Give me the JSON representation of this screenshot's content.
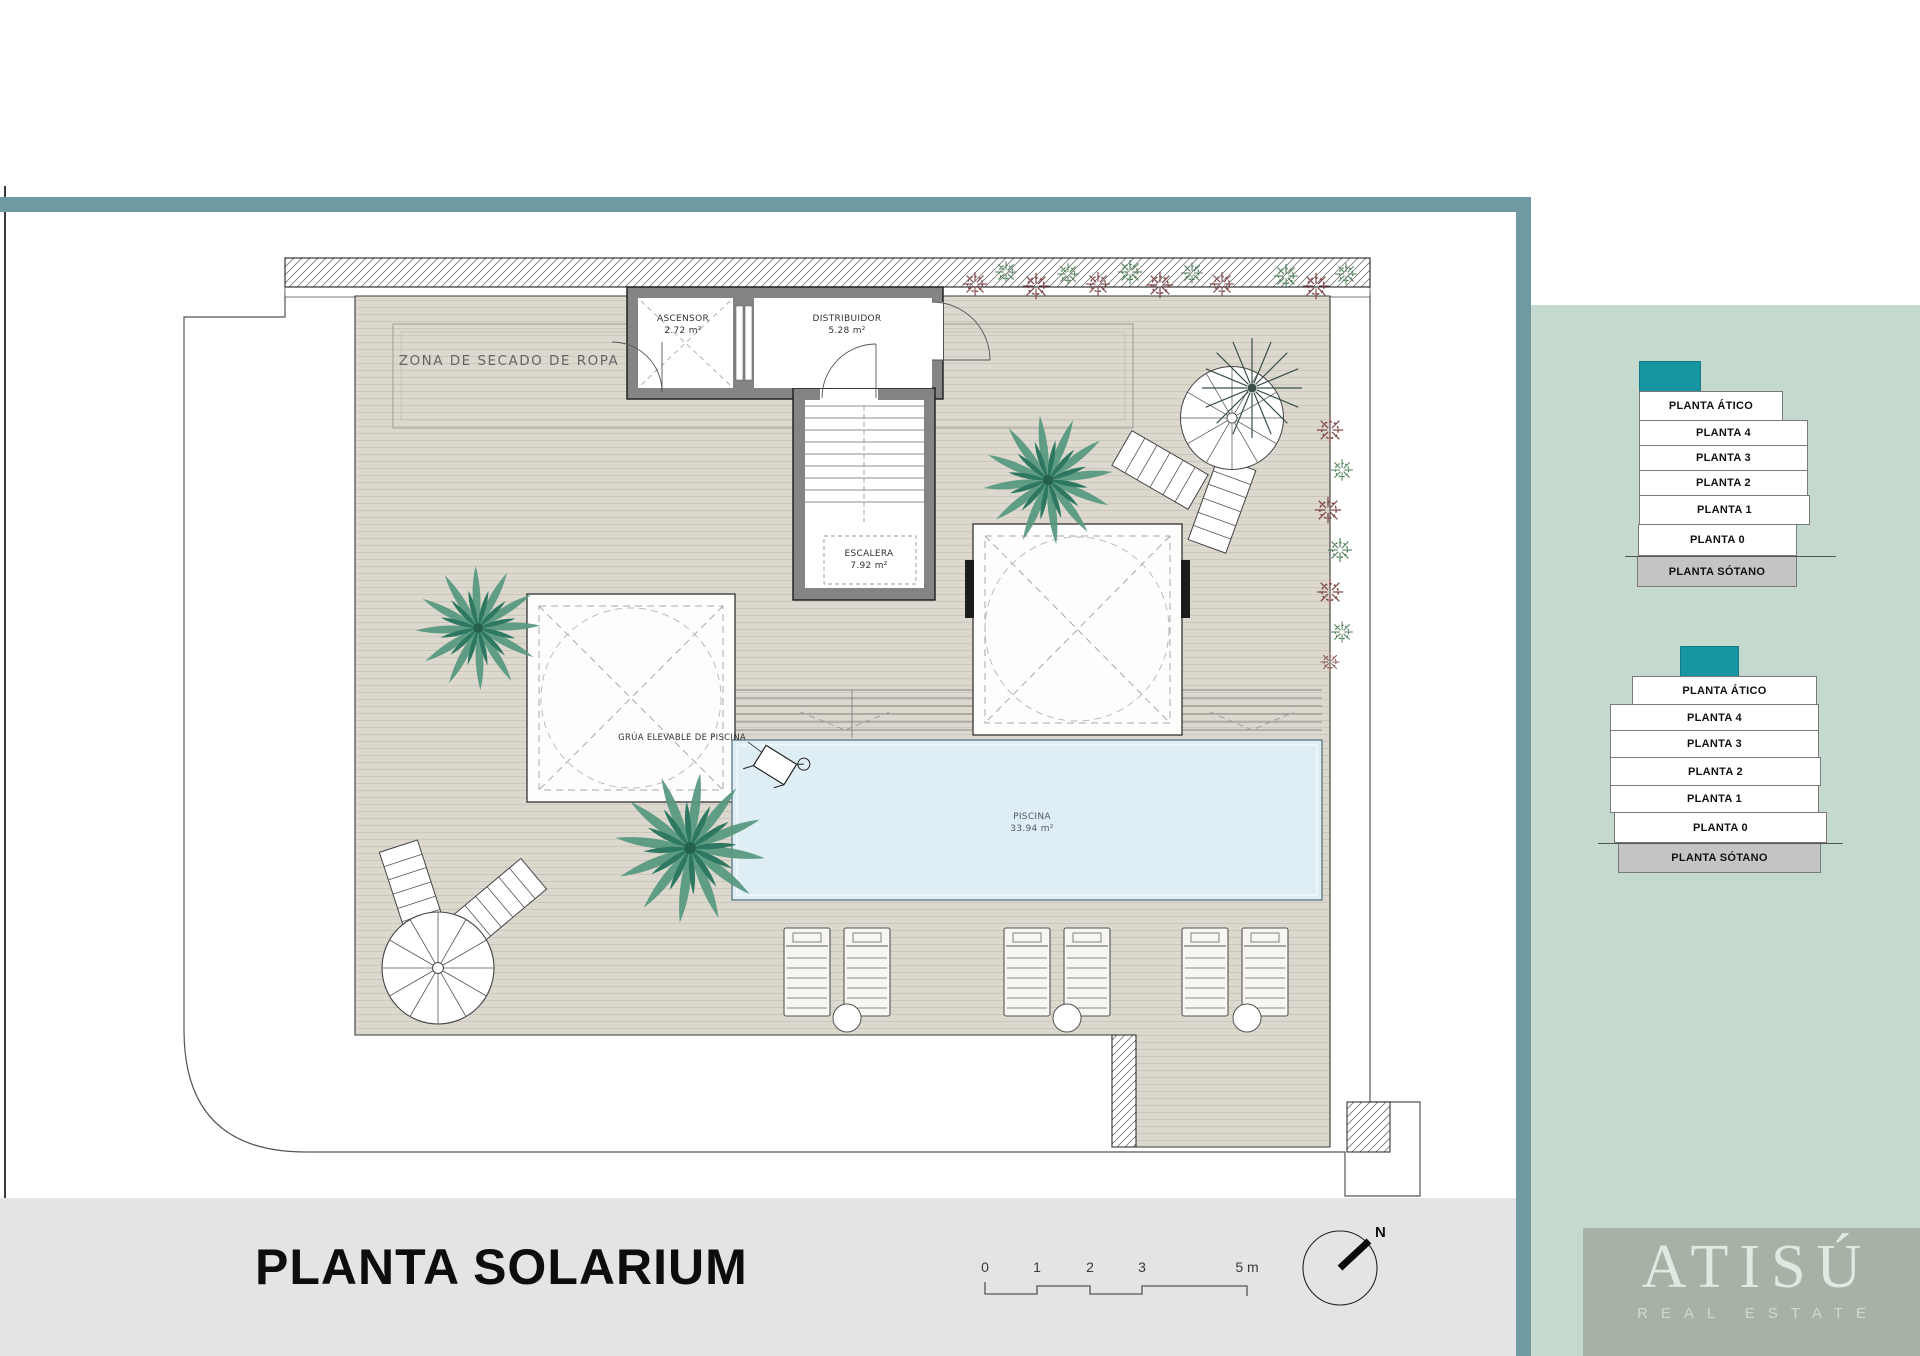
{
  "plan": {
    "zone_label": "ZONA DE SECADO DE ROPA",
    "rooms": {
      "ascensor": {
        "name": "ASCENSOR",
        "area": "2.72 m²"
      },
      "distribuidor": {
        "name": "DISTRIBUIDOR",
        "area": "5.28 m²"
      },
      "escalera": {
        "name": "ESCALERA",
        "area": "7.92 m²"
      },
      "piscina": {
        "name": "PISCINA",
        "area": "33.94 m²"
      }
    },
    "crane_label": "GRÚA ELEVABLE DE PISCINA"
  },
  "sidebar": {
    "floors": [
      "PLANTA ÁTICO",
      "PLANTA 4",
      "PLANTA 3",
      "PLANTA 2",
      "PLANTA 1",
      "PLANTA 0",
      "PLANTA SÓTANO"
    ]
  },
  "footer": {
    "title": "PLANTA SOLARIUM",
    "scale_ticks": [
      "0",
      "1",
      "2",
      "3",
      "5 m"
    ],
    "north_label": "N"
  },
  "brand": {
    "name": "ATISÚ",
    "tagline": "REAL ESTATE"
  },
  "colors": {
    "frame_teal": "#6f9aa3",
    "sidebar_sage": "#c6d9cf",
    "floor_highlight_teal": "#1795a0",
    "sotano_gray": "#c4c4c4",
    "pool_blue": "#dfeef4",
    "deck_beige": "#dcd8ce",
    "footer_gray": "#e4e4e5",
    "logo_bg": "#a7b1a6"
  }
}
